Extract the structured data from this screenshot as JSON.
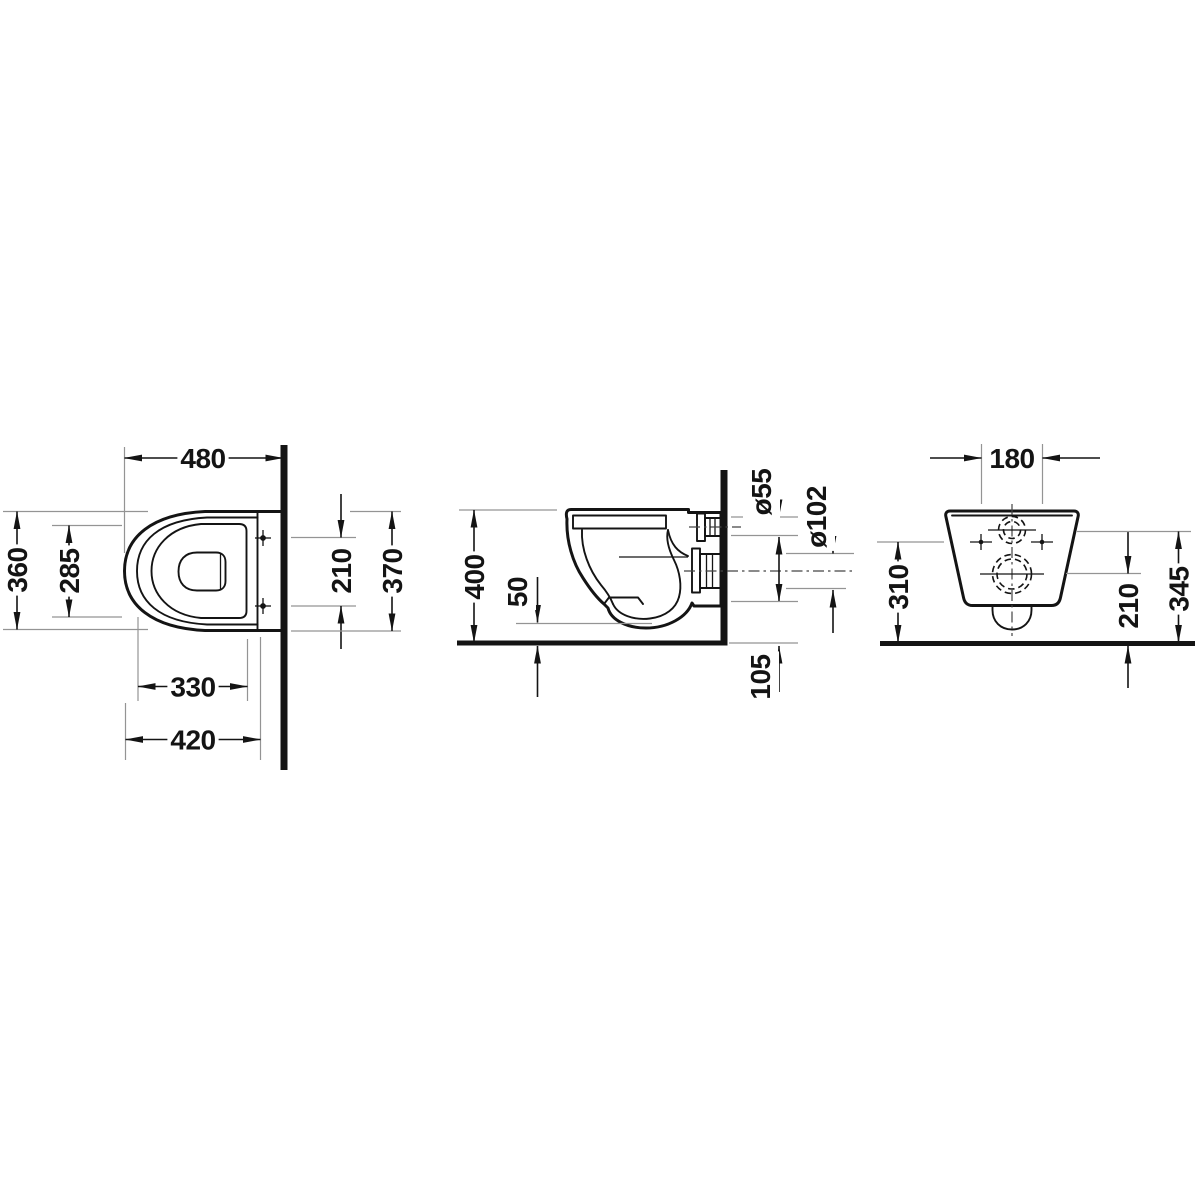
{
  "drawing": {
    "background": "#ffffff",
    "colors": {
      "line": "#141414",
      "extension": "#949494",
      "centerline": "#444444"
    },
    "views": {
      "top": {
        "name": "top view (plan)",
        "d480": "480",
        "d360": "360",
        "d285": "285",
        "d210": "210",
        "d370": "370",
        "d330": "330",
        "d420": "420"
      },
      "side": {
        "name": "side view (section)",
        "d400": "400",
        "d50": "50",
        "d55": "ø55",
        "d102": "ø102",
        "d105": "105"
      },
      "rear": {
        "name": "rear view",
        "d180": "180",
        "d310": "310",
        "d210": "210",
        "d345": "345"
      }
    }
  }
}
